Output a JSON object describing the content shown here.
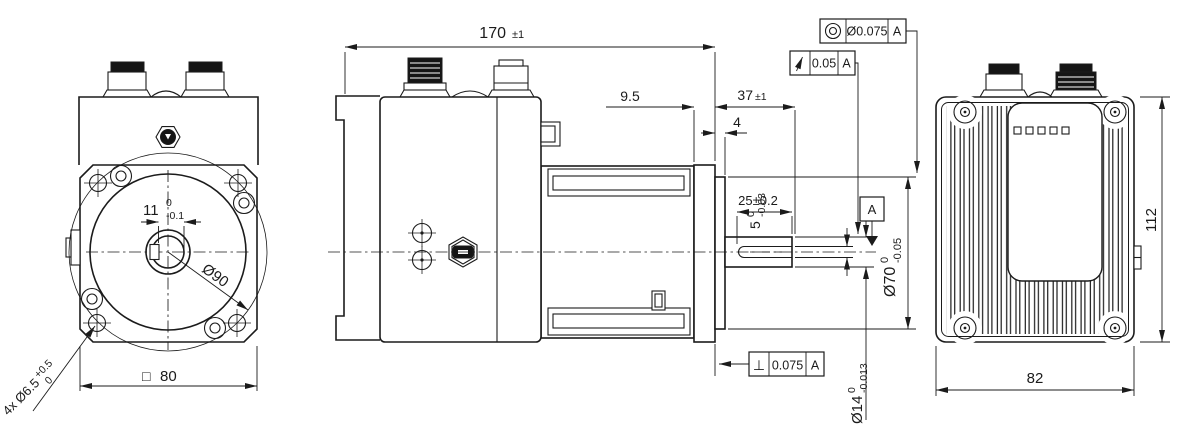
{
  "drawing": {
    "type": "technical-dimension-drawing",
    "background": "#ffffff",
    "line_color": "#1b1b1b",
    "views": {
      "front": "front-view",
      "side": "side-view",
      "back": "back-view"
    },
    "dims": {
      "overall_length": {
        "value": "170",
        "tol": "±1"
      },
      "flange_thickness": {
        "value": "9.5"
      },
      "shaft_length": {
        "value": "37",
        "tol": "±1"
      },
      "pilot_length": {
        "value": "4"
      },
      "keyway_length": {
        "value": "25±0.2"
      },
      "keyway_width": {
        "value": "5",
        "upper": "0",
        "lower": "-0.03"
      },
      "pilot_diameter": {
        "value": "Ø70",
        "upper": "0",
        "lower": "-0.05"
      },
      "shaft_diameter": {
        "value": "Ø14",
        "upper": "0",
        "lower": "-0.013"
      },
      "key_depth": {
        "value": "11",
        "upper": "0",
        "lower": "-0.1"
      },
      "register_diameter": {
        "value": "Ø90"
      },
      "flange_square": {
        "symbol": "□",
        "value": "80"
      },
      "mounting_holes": {
        "value": "4x Ø6.5",
        "upper": "+0.5",
        "lower": "0"
      },
      "body_height": {
        "value": "112"
      },
      "body_width": {
        "value": "82"
      }
    },
    "gdt": {
      "concentricity": {
        "tolerance": "Ø0.075",
        "datum": "A"
      },
      "circular_runout": {
        "tolerance": "0.05",
        "datum": "A"
      },
      "perpendicularity": {
        "symbol": "⊥",
        "tolerance": "0.075",
        "datum": "A"
      },
      "datum_label": "A"
    }
  }
}
